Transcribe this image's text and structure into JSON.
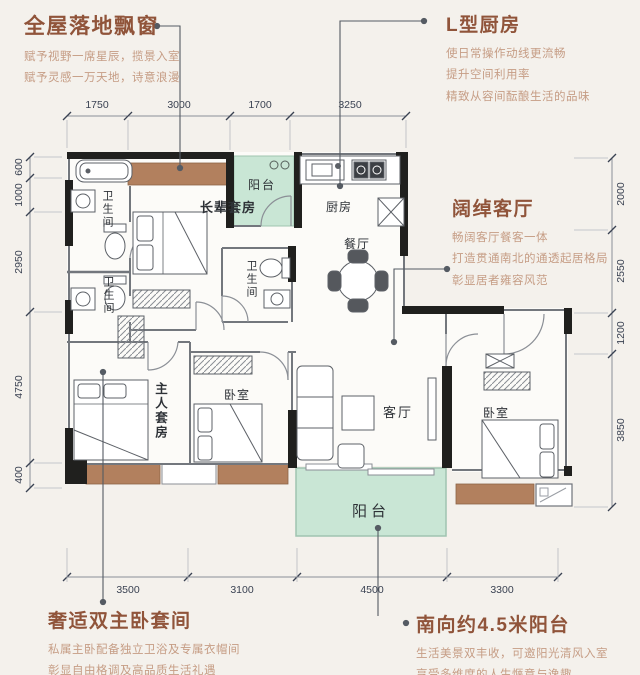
{
  "annotations": {
    "bay_window": {
      "title": "全屋落地飘窗",
      "lines": [
        "赋予视野一席星辰，揽景入室",
        "赋予灵感一万天地，诗意浪漫"
      ]
    },
    "kitchen": {
      "title": "L型厨房",
      "lines": [
        "使日常操作动线更流畅",
        "提升空间利用率",
        "精致从容间酝酿生活的品味"
      ]
    },
    "living": {
      "title": "阔绰客厅",
      "lines": [
        "畅阔客厅餐客一体",
        "打造贯通南北的通透起居格局",
        "彰显居者雍容风范"
      ]
    },
    "master": {
      "title": "奢适双主卧套间",
      "lines": [
        "私属主卧配备独立卫浴及专属衣帽间",
        "彰显自由格调及高品质生活礼遇"
      ]
    },
    "balcony": {
      "title": "南向约4.5米阳台",
      "lines": [
        "生活美景双丰收，可邀阳光清风入室",
        "享受多维度的人生惬意与逸趣"
      ]
    }
  },
  "rooms": {
    "balcony_top": "阳台",
    "kitchen": "厨房",
    "dining": "餐厅",
    "elder_suite": "长辈套房",
    "bath1": "卫生间",
    "bath2": "卫生间",
    "bath3": "卫生间",
    "master_suite": "主人套房",
    "bedroom_left": "卧室",
    "living": "客厅",
    "bedroom_right": "卧室",
    "balcony_bottom": "阳台"
  },
  "dims": {
    "top": [
      "1750",
      "3000",
      "1700",
      "3250"
    ],
    "bottom": [
      "3500",
      "3100",
      "4500",
      "3300"
    ],
    "left": [
      "600",
      "1000",
      "2950",
      "4750",
      "400"
    ],
    "right": [
      "2000",
      "2550",
      "1200",
      "3850"
    ]
  },
  "colors": {
    "title_brown": "#90543a",
    "body_brown": "#c69d85",
    "dim_text": "#3a4252",
    "wall_black": "#20201e",
    "balcony_green": "#c9e6d5",
    "bay_brown": "#b2805e",
    "background": "#f4f1ec"
  }
}
